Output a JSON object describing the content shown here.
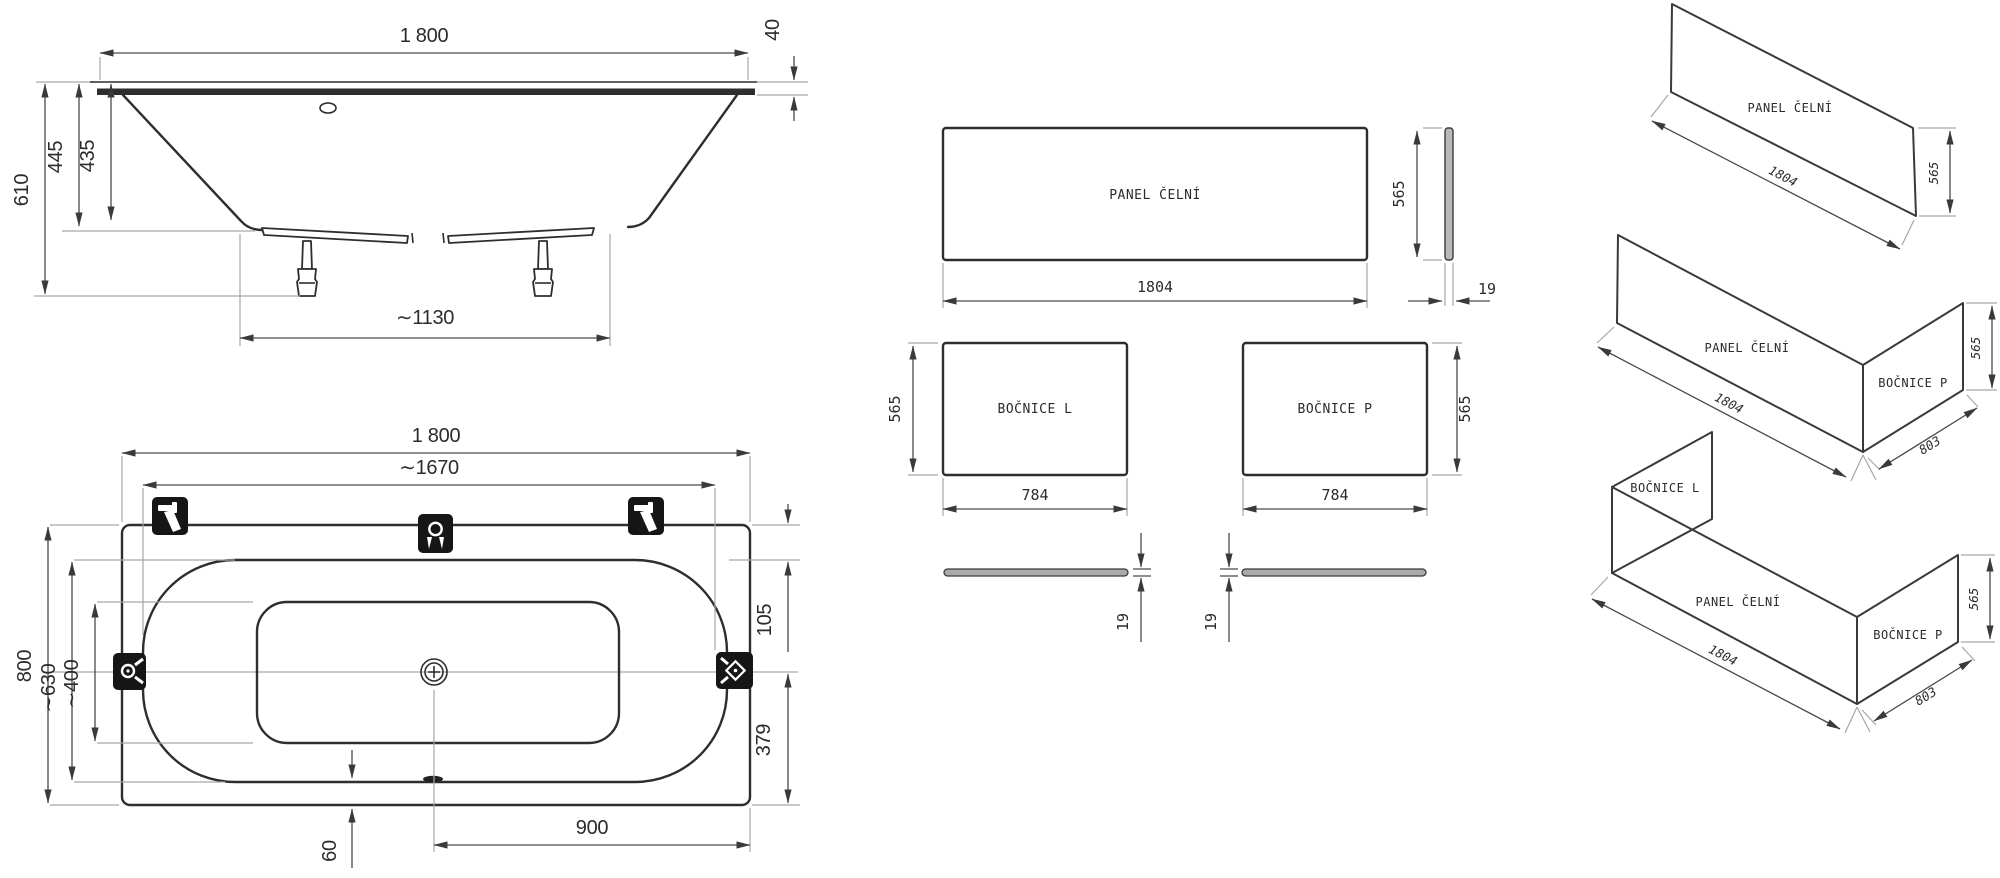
{
  "side_view": {
    "overall_length": "1 800",
    "rim_height": "40",
    "total_height": "610",
    "body_height": "445",
    "depth": "435",
    "feet_spacing": "∼1130"
  },
  "top_view": {
    "overall_length": "1 800",
    "inner_length": "∼1670",
    "overall_width": "800",
    "inner_width": "∼630",
    "bottom_width": "∼400",
    "edge_to_rim_top": "105",
    "center_to_edge_bottom": "379",
    "drain_to_end": "900",
    "rim_to_edge": "60"
  },
  "panels": {
    "front": {
      "label": "PANEL ČELNÍ",
      "length": "1804",
      "height": "565",
      "thickness": "19"
    },
    "left": {
      "label": "BOČNICE L",
      "length": "784",
      "height": "565",
      "thickness": "19"
    },
    "right": {
      "label": "BOČNICE P",
      "length": "784",
      "height": "565",
      "thickness": "19"
    }
  },
  "assembly": {
    "front_only": {
      "panel": "PANEL ČELNÍ",
      "length": "1804",
      "height": "565"
    },
    "front_right": {
      "panel": "PANEL ČELNÍ",
      "side": "BOČNICE P",
      "length": "1804",
      "height": "565",
      "depth": "803"
    },
    "full": {
      "side_left": "BOČNICE L",
      "panel": "PANEL ČELNÍ",
      "side_right": "BOČNICE P",
      "length": "1804",
      "height": "565",
      "depth": "803"
    }
  }
}
